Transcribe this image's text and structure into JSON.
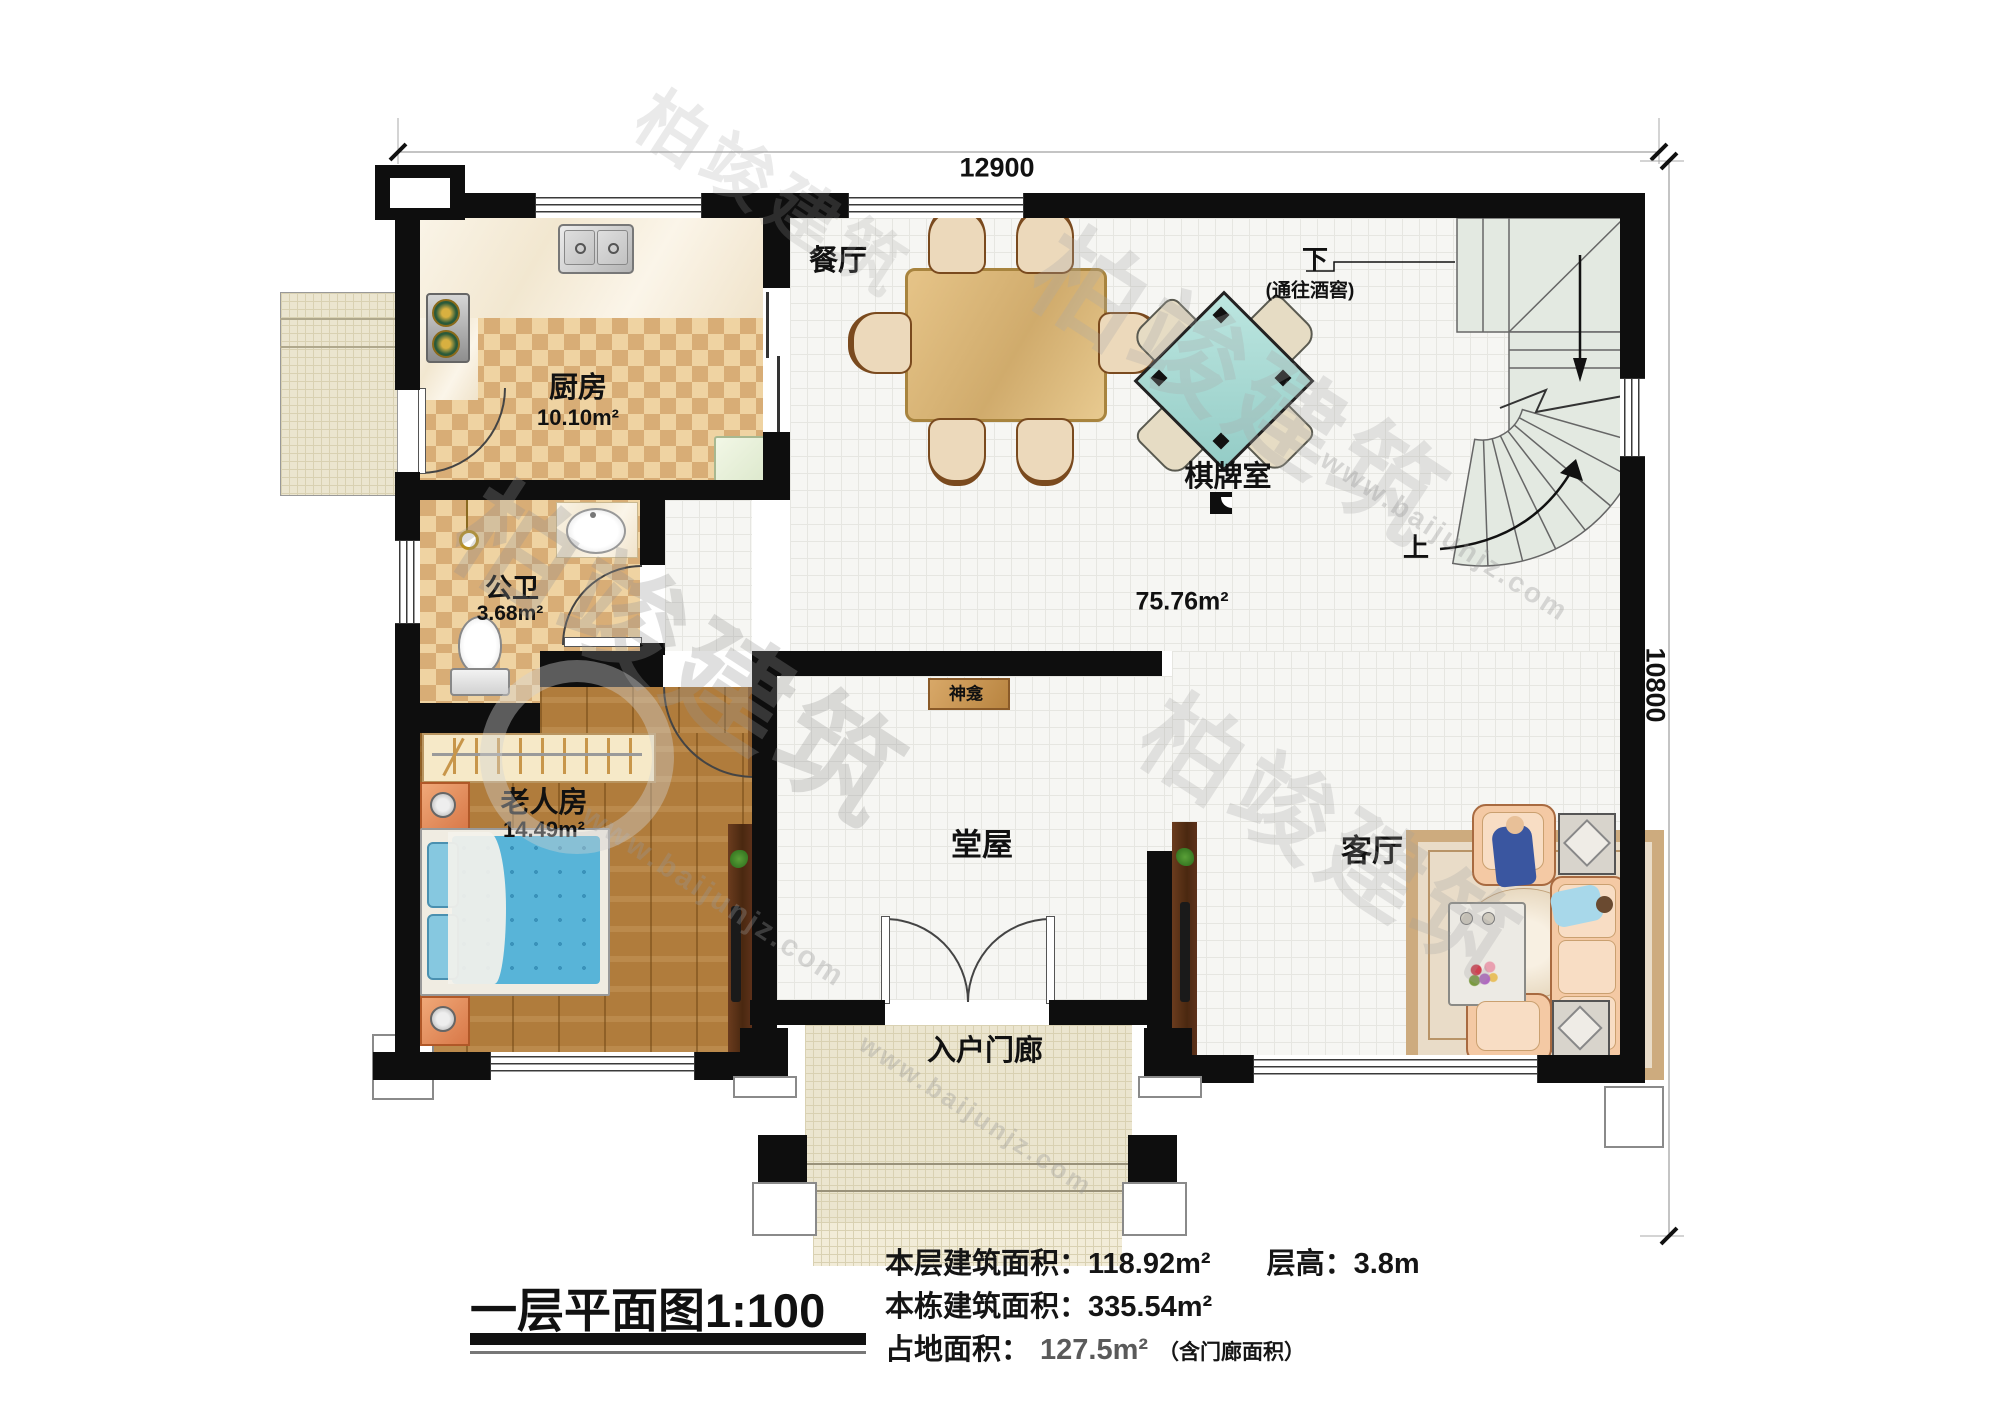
{
  "title": {
    "name": "一层平面图",
    "scale": "1:100"
  },
  "dimensions": {
    "top": "12900",
    "right": "10800"
  },
  "rooms": {
    "dining": {
      "name": "餐厅"
    },
    "kitchen": {
      "name": "厨房",
      "area": "10.10m²"
    },
    "chess": {
      "name": "棋牌室"
    },
    "bath": {
      "name": "公卫",
      "area": "3.68m²"
    },
    "bedroom": {
      "name": "老人房",
      "area": "14.49m²"
    },
    "hall": {
      "name": "堂屋"
    },
    "living": {
      "name": "客厅"
    },
    "porch": {
      "name": "入户门廊"
    },
    "open": {
      "area": "75.76m²"
    },
    "shrine": {
      "name": "神龛"
    }
  },
  "stairs": {
    "down": "下",
    "down_note": "(通往酒窖)",
    "up": "上"
  },
  "stats": {
    "floor_area_label": "本层建筑面积：",
    "floor_area": "118.92m²",
    "height_label": "层高：",
    "height": "3.8m",
    "building_area_label": "本栋建筑面积：",
    "building_area": "335.54m²",
    "land_area_label": "占地面积：",
    "land_area": "127.5m²",
    "land_note": "（含门廊面积）"
  },
  "watermark": {
    "brand": "柏竣建筑",
    "url": "www.baijunjz.com"
  },
  "colors": {
    "wall": "#0e0e0e",
    "checker_tan": "#d8ad76",
    "wood_floor": "#b07c3c",
    "chess_table": "#a9dbd6",
    "sofa": "#f4c9a4",
    "bed": "#58b4d8",
    "stair": "#e3e9e1"
  }
}
